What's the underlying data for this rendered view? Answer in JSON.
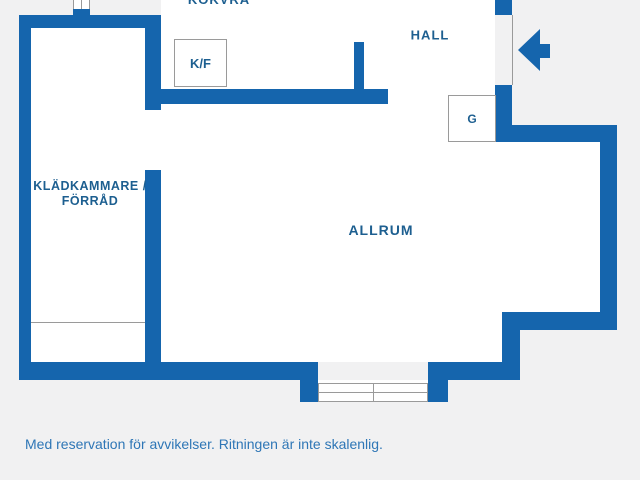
{
  "plan": {
    "rooms": {
      "kokvra": {
        "label": "KOKVRÅ"
      },
      "hall": {
        "label": "HALL"
      },
      "kladkammare": {
        "label_line1": "KLÄDKAMMARE /",
        "label_line2": "FÖRRÅD"
      },
      "allrum": {
        "label": "ALLRUM"
      }
    },
    "fixtures": {
      "fridge_freezer": {
        "label": "K/F"
      },
      "wardrobe": {
        "label": "G"
      }
    },
    "colors": {
      "wall": "#1565ad",
      "label": "#1d5f90",
      "disclaimer": "#2e76b6",
      "background": "#f1f1f2"
    }
  },
  "footer": {
    "disclaimer": "Med reservation för avvikelser. Ritningen är inte skalenlig."
  }
}
